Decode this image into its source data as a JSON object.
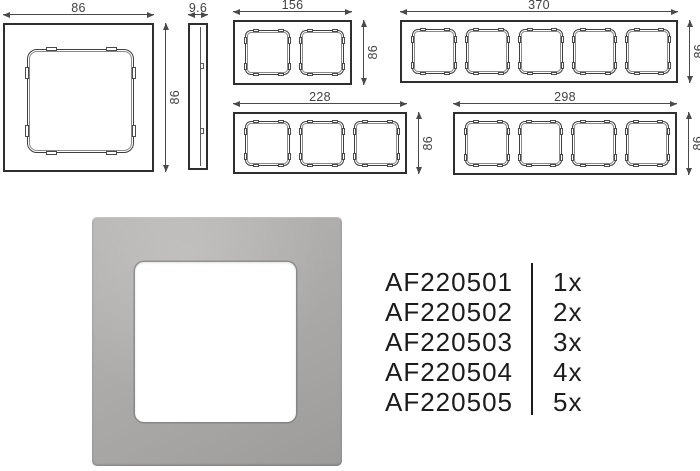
{
  "colors": {
    "background": "#ffffff",
    "drawing_line": "#2e2e2e",
    "dimension_text": "#424242",
    "parts_text": "#1c1c1c",
    "photo_frame_gray": "#aaa9a7",
    "photo_cutout": "#ffffff"
  },
  "drawings": [
    {
      "name": "frame-1gang-front",
      "kind": "front",
      "gangs": 1,
      "x": 3,
      "y": 23,
      "w": 151,
      "h": 149,
      "dims": [
        {
          "side": "top",
          "label": "86"
        },
        {
          "side": "right",
          "label": "86"
        }
      ]
    },
    {
      "name": "frame-side-profile",
      "kind": "side",
      "x": 188,
      "y": 23,
      "w": 20,
      "h": 147,
      "dims": [
        {
          "side": "top",
          "label": "9.6"
        }
      ]
    },
    {
      "name": "frame-2gang-front",
      "kind": "front",
      "gangs": 2,
      "x": 233,
      "y": 20,
      "w": 119,
      "h": 65,
      "dims": [
        {
          "side": "top",
          "label": "156"
        },
        {
          "side": "right",
          "label": "86"
        }
      ]
    },
    {
      "name": "frame-5gang-front",
      "kind": "front",
      "gangs": 5,
      "x": 400,
      "y": 20,
      "w": 278,
      "h": 63,
      "dims": [
        {
          "side": "top",
          "label": "370"
        },
        {
          "side": "right",
          "label": "86"
        }
      ]
    },
    {
      "name": "frame-3gang-front",
      "kind": "front",
      "gangs": 3,
      "x": 233,
      "y": 112,
      "w": 174,
      "h": 62,
      "dims": [
        {
          "side": "top",
          "label": "228"
        },
        {
          "side": "right",
          "label": "86"
        }
      ]
    },
    {
      "name": "frame-4gang-front",
      "kind": "front",
      "gangs": 4,
      "x": 453,
      "y": 112,
      "w": 224,
      "h": 63,
      "dims": [
        {
          "side": "top",
          "label": "298"
        },
        {
          "side": "right",
          "label": "86"
        }
      ]
    }
  ],
  "parts": [
    {
      "sku": "AF220501",
      "qty": "1x"
    },
    {
      "sku": "AF220502",
      "qty": "2x"
    },
    {
      "sku": "AF220503",
      "qty": "3x"
    },
    {
      "sku": "AF220504",
      "qty": "4x"
    },
    {
      "sku": "AF220505",
      "qty": "5x"
    }
  ]
}
